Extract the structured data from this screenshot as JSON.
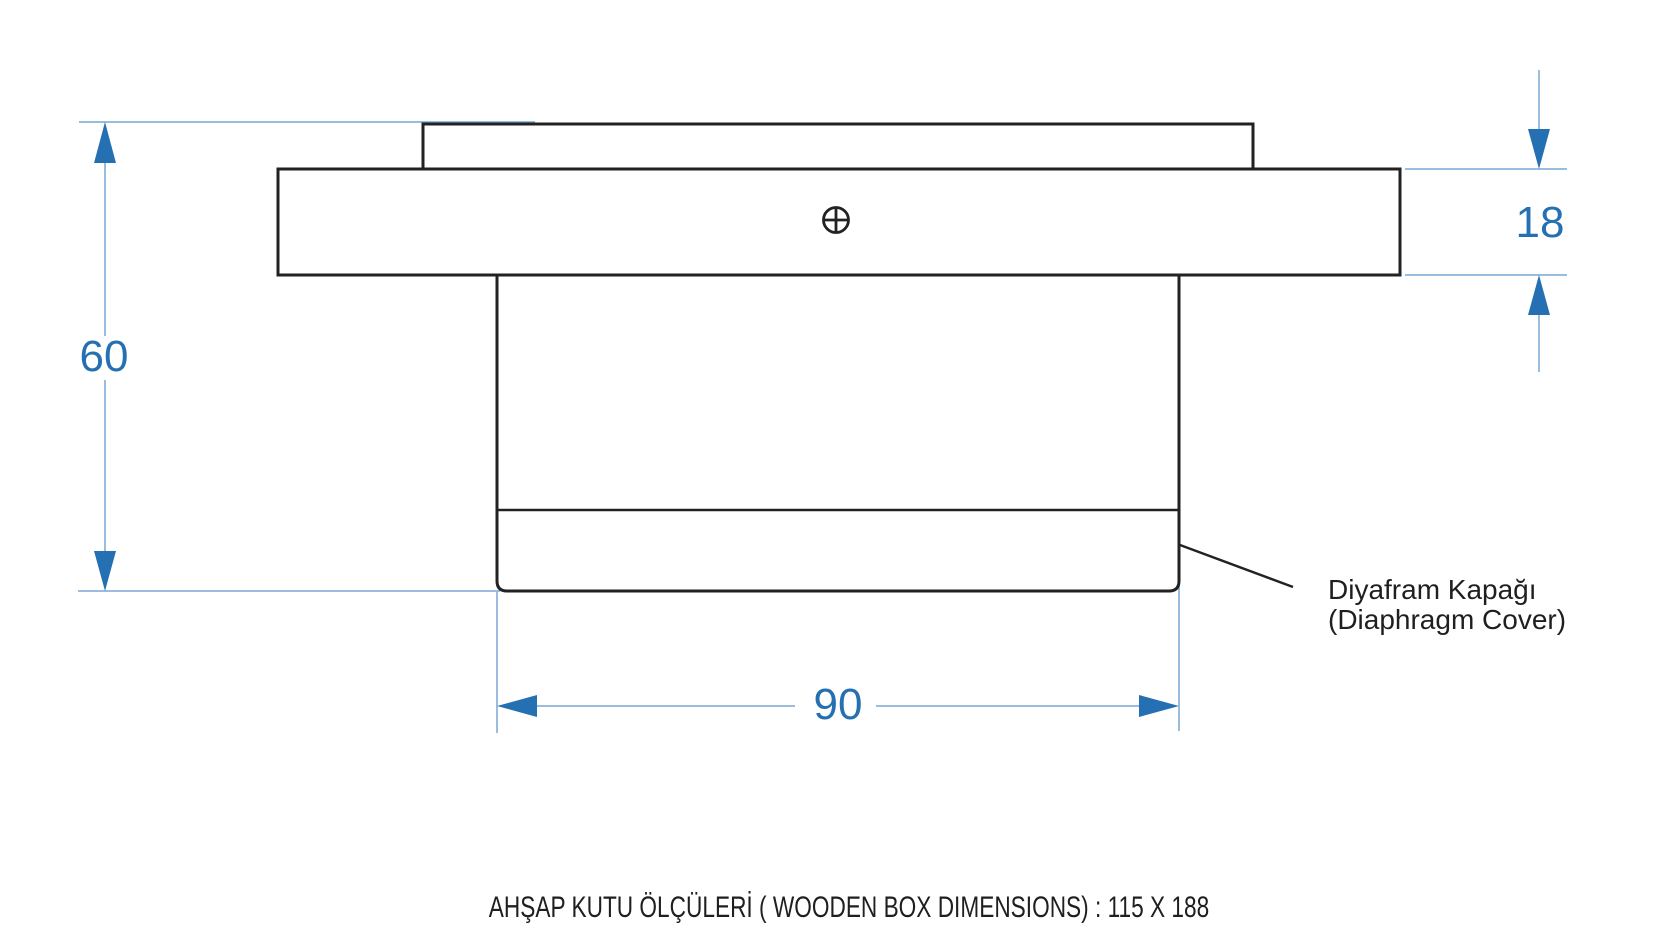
{
  "drawing": {
    "title_caption": "AHŞAP KUTU ÖLÇÜLERİ ( WOODEN BOX DIMENSIONS) : 115 X 188",
    "dimensions": {
      "total_height": "60",
      "flange_thickness": "18",
      "body_width": "90"
    },
    "labels": {
      "diaphragm_cover_native": "Diyafram Kapağı",
      "diaphragm_cover_english": "(Diaphragm Cover)"
    },
    "icons": {
      "center_mark": "circle-with-cross"
    },
    "colors": {
      "dimension_blue": "#2470b2",
      "extension_line_blue": "#7aa7d2",
      "outline_dark": "#222222",
      "background": "#ffffff"
    }
  }
}
